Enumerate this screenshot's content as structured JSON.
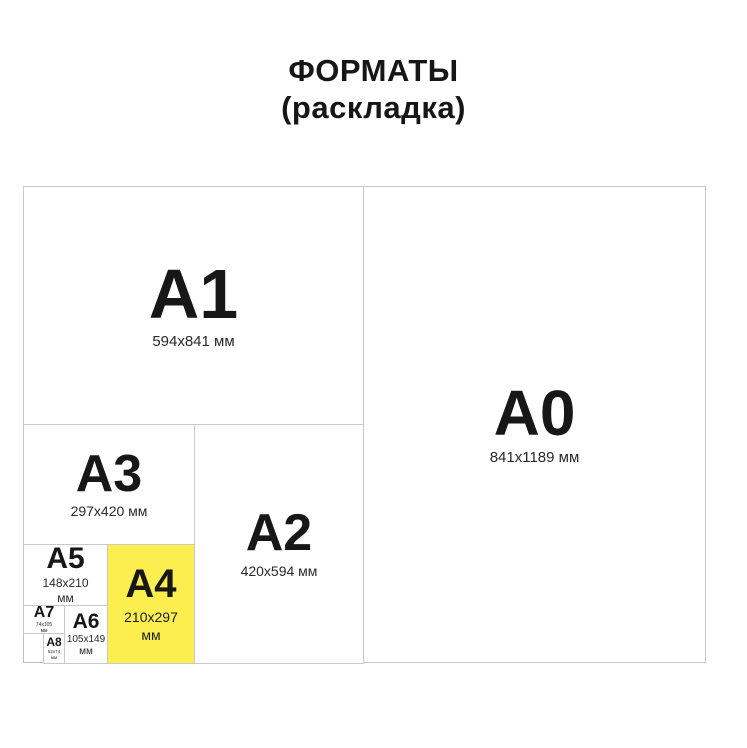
{
  "title": {
    "line1": "ФОРМАТЫ",
    "line2": "(раскладка)"
  },
  "colors": {
    "highlight_yellow": "#FBEE4E",
    "border_gray": "#C9C9C9",
    "text": "#1C1C1C"
  },
  "formats": {
    "a0": {
      "label": "A0",
      "dims": "841x1189 мм"
    },
    "a1": {
      "label": "A1",
      "dims": "594x841 мм"
    },
    "a2": {
      "label": "A2",
      "dims": "420x594 мм"
    },
    "a3": {
      "label": "A3",
      "dims": "297x420 мм"
    },
    "a4": {
      "label": "A4",
      "dims_line1": "210x297",
      "dims_line2": "мм",
      "highlighted": "true"
    },
    "a5": {
      "label": "A5",
      "dims_line1": "148x210",
      "dims_line2": "мм"
    },
    "a6": {
      "label": "A6",
      "dims_line1": "105x149",
      "dims_line2": "мм"
    },
    "a7": {
      "label": "A7",
      "dims_line1": "74x105",
      "dims_line2": "мм"
    },
    "a8": {
      "label": "A8",
      "dims_line1": "52x74",
      "dims_line2": "мм"
    }
  }
}
